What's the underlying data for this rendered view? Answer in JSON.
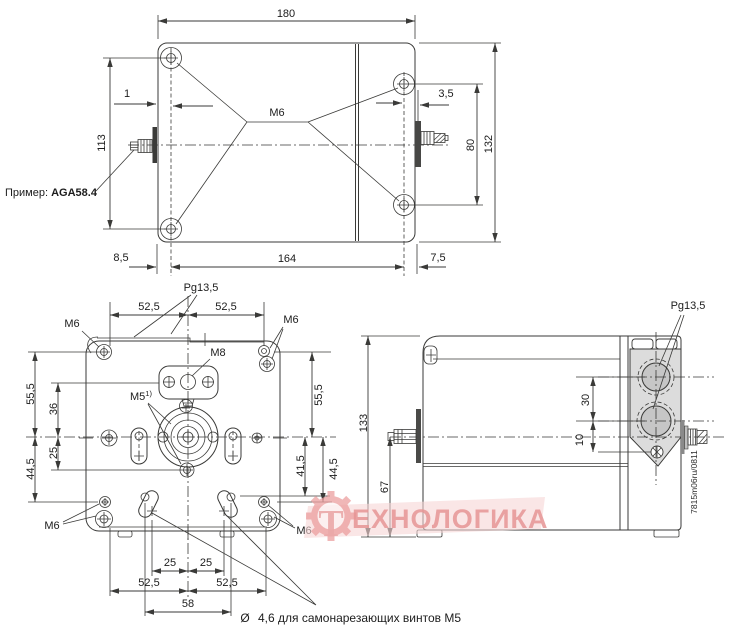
{
  "top_view": {
    "width": "180",
    "height_left": "113",
    "offset_left": "1",
    "offset_right": "3,5",
    "hole_spacing_right": "80",
    "height_right": "132",
    "margin_left": "8,5",
    "hole_spacing_bottom": "164",
    "margin_right": "7,5",
    "thread": "M6",
    "example_label": "Пример: ",
    "example_value": "AGA58.4"
  },
  "front_view": {
    "cable_gland": "Pg13,5",
    "dim_52_5": "52,5",
    "thread_m6": "M6",
    "thread_m8": "M8",
    "thread_m5": "M5",
    "thread_m5_note": "1)",
    "dim_55_5": "55,5",
    "dim_36": "36",
    "dim_25": "25",
    "dim_44_5": "44,5",
    "dim_41_5": "41,5",
    "dim_58": "58",
    "note_symbol": "Ø",
    "note_text": "4,6 для самонарезающих винтов M5"
  },
  "side_view": {
    "cable_gland": "Pg13,5",
    "height": "133",
    "height_base": "67",
    "gland_spacing": "30",
    "gland_offset": "10",
    "doc_number": "7815m06ru/0811"
  },
  "watermark": {
    "logo_letter": "Т",
    "text": "ЕХНОЛОГИКА"
  }
}
